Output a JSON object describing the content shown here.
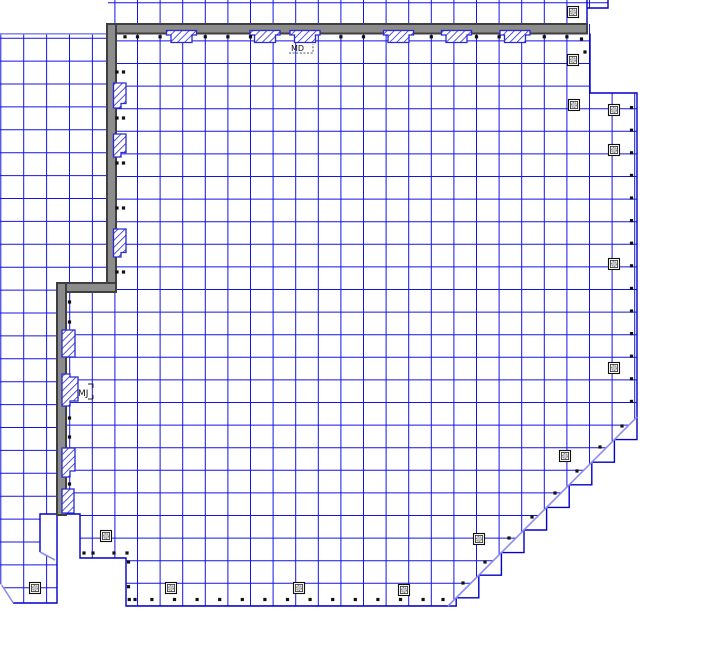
{
  "drawing": {
    "title": "structural-grid-floor-plan",
    "labels": {
      "md": "MD",
      "mj": "MJ"
    },
    "colors": {
      "background": "#ffffff",
      "grid_blue": "#1414e6",
      "boundary_blue": "#0000c8",
      "light_blue": "#8c8cf0",
      "wall_fill": "#8c8c8c",
      "wall_edge": "#3f3f3f",
      "hatch_blue": "#2a2ad0",
      "mark_black": "#101010",
      "column_gray": "#c4c4c4"
    }
  }
}
